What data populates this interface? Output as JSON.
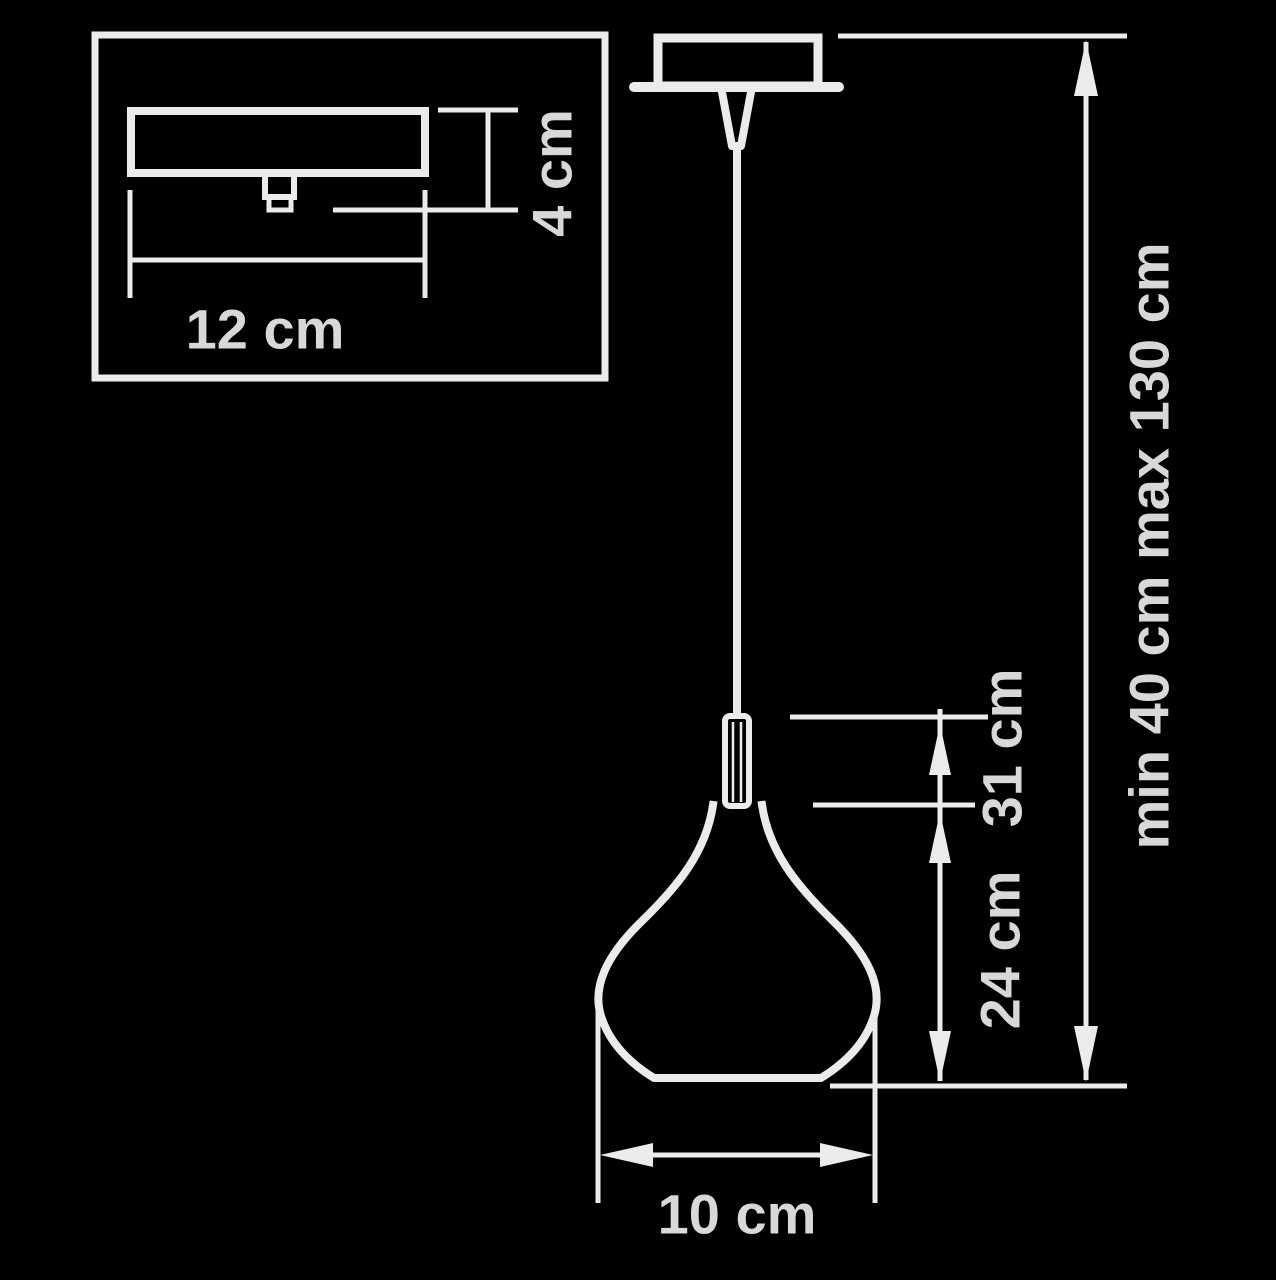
{
  "diagram": {
    "colors": {
      "background": "#000000",
      "line": "#ebebeb",
      "text": "#d8d8d8"
    },
    "labels": {
      "canopy_width": "12 cm",
      "canopy_height": "4 cm",
      "body_height": "31 cm",
      "shade_height": "24 cm",
      "total_height": "min 40 cm max 130 cm",
      "shade_diameter": "10 cm"
    }
  }
}
